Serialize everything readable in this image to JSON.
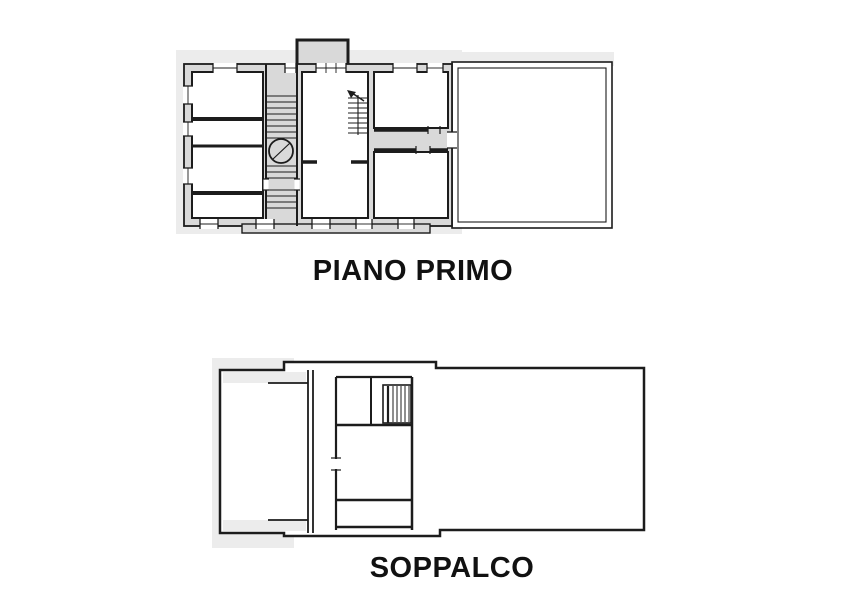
{
  "page": {
    "background": "#ffffff"
  },
  "colors": {
    "wall_line": "#1c1c1c",
    "wall_fill": "#d9d9d9",
    "halo": "#ececec",
    "room_fill": "#ffffff",
    "label_color": "#111111",
    "page_bg": "#ffffff"
  },
  "plans": [
    {
      "id": "piano-primo",
      "label": "PIANO PRIMO"
    },
    {
      "id": "soppalco",
      "label": "SOPPALCO"
    }
  ]
}
